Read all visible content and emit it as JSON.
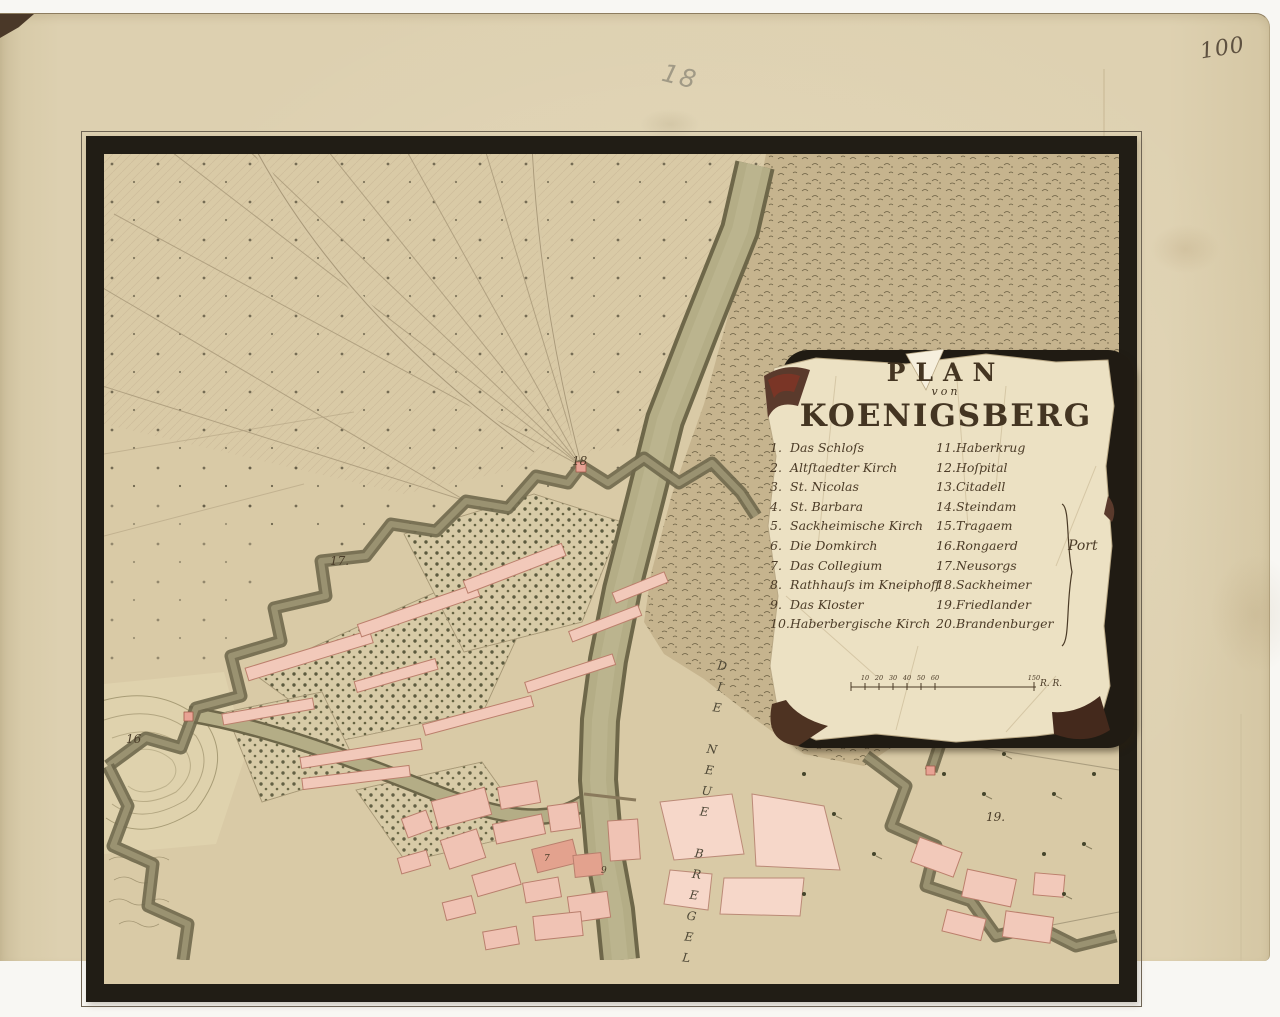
{
  "page": {
    "folio_number": "100",
    "pencil_sheet_number": "18"
  },
  "cartouche": {
    "title": {
      "line1": "PLAN",
      "line2": "von",
      "line3": "KOENIGSBERG"
    },
    "legend_left": [
      {
        "n": "1.",
        "t": "Das Schloſs"
      },
      {
        "n": "2.",
        "t": "Altſtaedter Kirch"
      },
      {
        "n": "3.",
        "t": "St. Nicolas"
      },
      {
        "n": "4.",
        "t": "St. Barbara"
      },
      {
        "n": "5.",
        "t": "Sackheimische Kirch"
      },
      {
        "n": "6.",
        "t": "Die Domkirch"
      },
      {
        "n": "7.",
        "t": "Das Collegium"
      },
      {
        "n": "8.",
        "t": "Rathhauſs im Kneiphoff"
      },
      {
        "n": "9.",
        "t": "Das Kloster"
      },
      {
        "n": "10.",
        "t": "Haberbergische Kirch"
      }
    ],
    "legend_right": [
      {
        "n": "11.",
        "t": "Haberkrug"
      },
      {
        "n": "12.",
        "t": "Hoſpital"
      },
      {
        "n": "13.",
        "t": "Citadell"
      },
      {
        "n": "14.",
        "t": "Steindam"
      },
      {
        "n": "15.",
        "t": "Tragaem"
      },
      {
        "n": "16.",
        "t": "Rongaerd"
      },
      {
        "n": "17.",
        "t": "Neusorgs"
      },
      {
        "n": "18.",
        "t": "Sackheimer"
      },
      {
        "n": "19.",
        "t": "Friedlander"
      },
      {
        "n": "20.",
        "t": "Brandenburger"
      }
    ],
    "bracket_label": "Port",
    "scale": {
      "ticks": [
        "10",
        "20",
        "30",
        "40",
        "50",
        "60"
      ],
      "end": "150",
      "unit": "R. R."
    }
  },
  "map": {
    "river_label": "DIE NEUE BREGEL",
    "markers": {
      "m16": "16",
      "m17": "17.",
      "m18": "18",
      "m19": "19.",
      "b7": "7",
      "b9": "9"
    }
  },
  "colors": {
    "paper": "#ddd0b0",
    "map_field": "#d9caa6",
    "heath": "#c6b48e",
    "water": "#b4ad86",
    "rampart": "#837b5d",
    "building_pink": "#f2c9ba",
    "tree_green": "#4f4e33",
    "frame_black": "#211d15",
    "ink": "#463827",
    "parchment": "#ece1c3"
  }
}
